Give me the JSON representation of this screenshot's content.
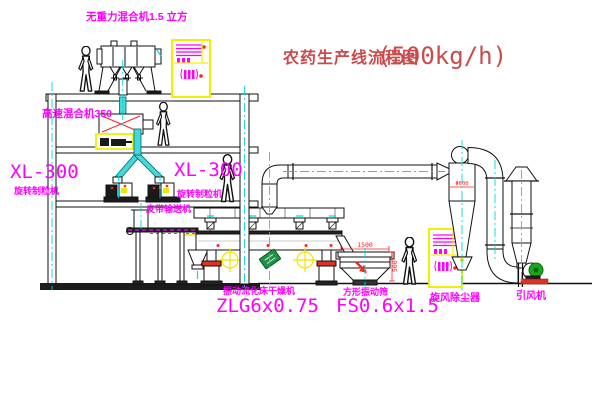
{
  "diagram": {
    "title": {
      "name": "农药生产线流程图",
      "capacity": "(500kg/h)"
    },
    "labels": {
      "gravity_free_mixer": "无重力混合机1.5 立方",
      "high_speed_mixer": "高速混合机350",
      "granulator_left_model": "XL-300",
      "granulator_left_name": "旋转制粒机",
      "granulator_right_model": "XL-300",
      "granulator_right_name": "旋转制粒机",
      "belt_conveyor": "皮带输送机",
      "fluid_bed_dryer_name": "振动流化床干燥机",
      "fluid_bed_dryer_model": "ZLG6x0.75",
      "square_sieve_name": "方形振动筛",
      "square_sieve_model": "FS0.6x1.5",
      "cyclone_dust_collector": "旋风除尘器",
      "induced_draft_fan": "引风机"
    },
    "dimensions": {
      "sieve_length": "1500",
      "sieve_height": "500",
      "cyclone_diameter": "Φ600"
    },
    "colors": {
      "label_magenta": "#ff00ff",
      "title_red": "#c94b4b",
      "equipment_yellow": "#f0f000",
      "centerline_cyan": "#00dcdc",
      "dimension_red": "#ff2020",
      "plate_green": "#1f9148",
      "motor_green": "#1ea51e"
    }
  }
}
